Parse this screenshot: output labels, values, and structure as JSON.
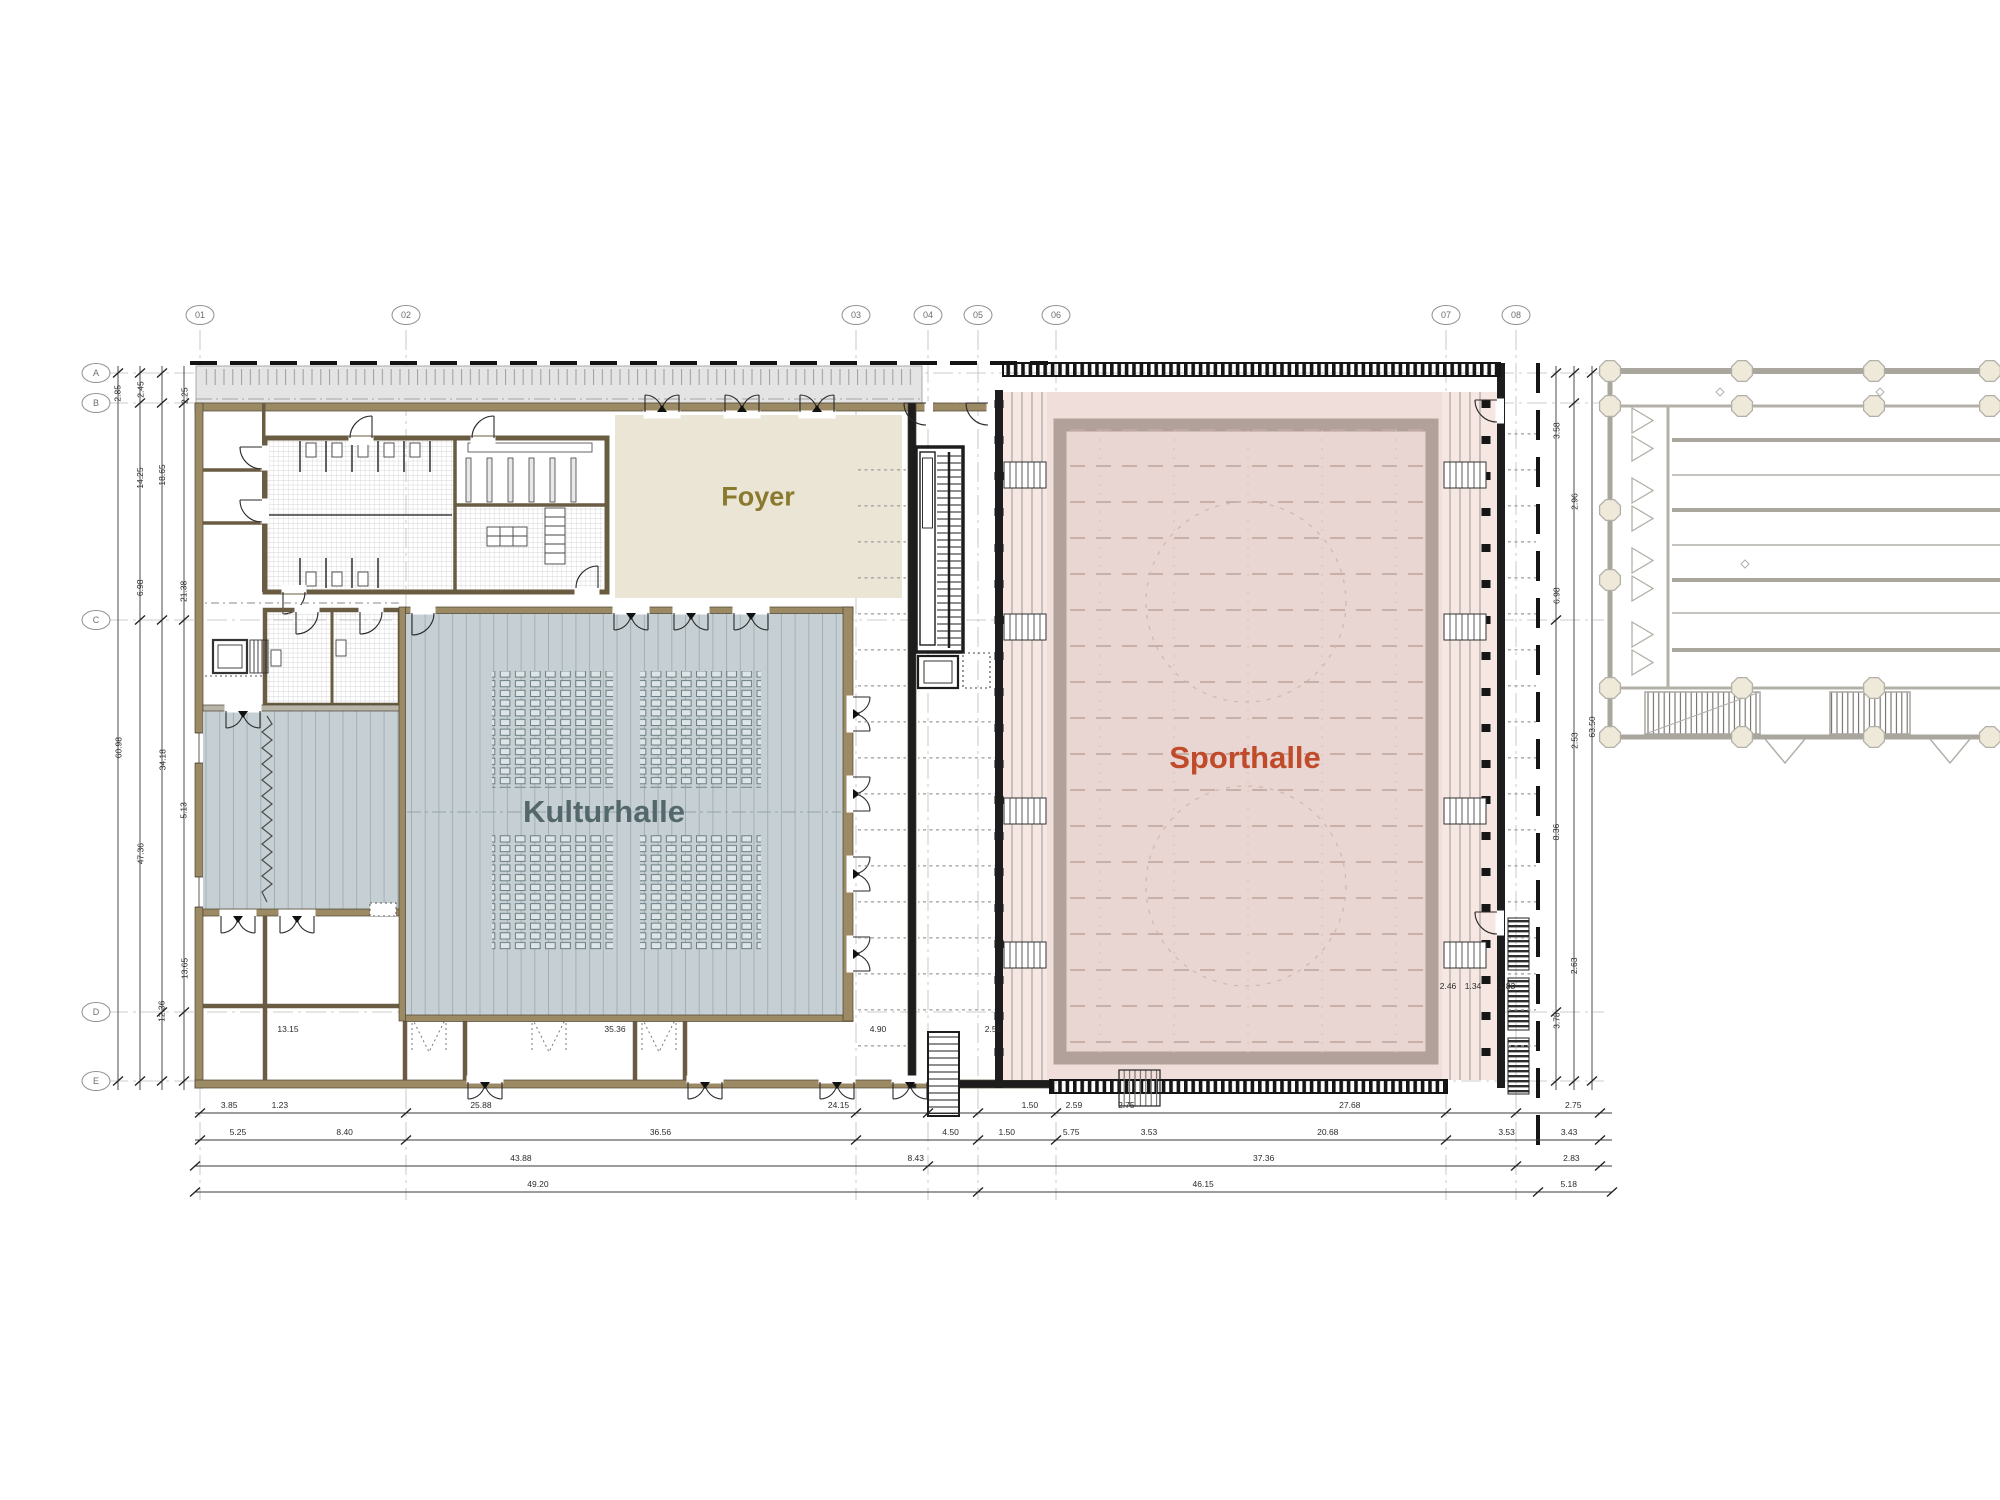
{
  "drawing": {
    "type": "architectural-floor-plan",
    "rooms": {
      "foyer": {
        "label": "Foyer",
        "fill": "#eae5d4",
        "text_color": "#8a7a2e"
      },
      "kulturhalle": {
        "label": "Kulturhalle",
        "fill": "#c6d0d4",
        "text_color": "#54686c"
      },
      "sporthalle": {
        "label": "Sporthalle",
        "fill": "#f0deda",
        "text_color": "#c04b2a"
      }
    },
    "grid_axes": {
      "columns": [
        "01",
        "02",
        "03",
        "04",
        "05",
        "06",
        "07",
        "08"
      ],
      "rows": [
        "A",
        "B",
        "C",
        "D",
        "E"
      ]
    },
    "dimensions": {
      "bottom_row1": [
        "3.85",
        "1.23",
        "25.88",
        "24.15",
        "1.50",
        "2.59",
        "2.75",
        "27.68",
        "2.75"
      ],
      "bottom_row2": [
        "5.25",
        "8.40",
        "36.56",
        "4.50",
        "1.50",
        "5.75",
        "3.53",
        "20.68",
        "3.53",
        "3.43"
      ],
      "bottom_row3": [
        "43.88",
        "8.43",
        "37.36",
        "2.83"
      ],
      "bottom_row4": [
        "49.20",
        "46.15",
        "5.18"
      ],
      "left_col1": [
        "2.85",
        "60.98"
      ],
      "left_col2": [
        "2.45",
        "14.25",
        "6.98",
        "47.36"
      ],
      "left_col3": [
        "18.65",
        "34.18",
        "12.36"
      ],
      "left_col4": [
        "2.25",
        "21.38",
        "5.13",
        "13.65"
      ],
      "right_col1": [
        "3.58",
        "6.98",
        "8.36",
        "3.78"
      ],
      "right_col2": [
        "2.96",
        "2.53",
        "2.63"
      ],
      "right_col3": [
        "63.50"
      ],
      "interior": [
        "13.15",
        "35.36",
        "4.90",
        "2.52",
        "2.46",
        "1.34",
        "1.83"
      ]
    }
  }
}
